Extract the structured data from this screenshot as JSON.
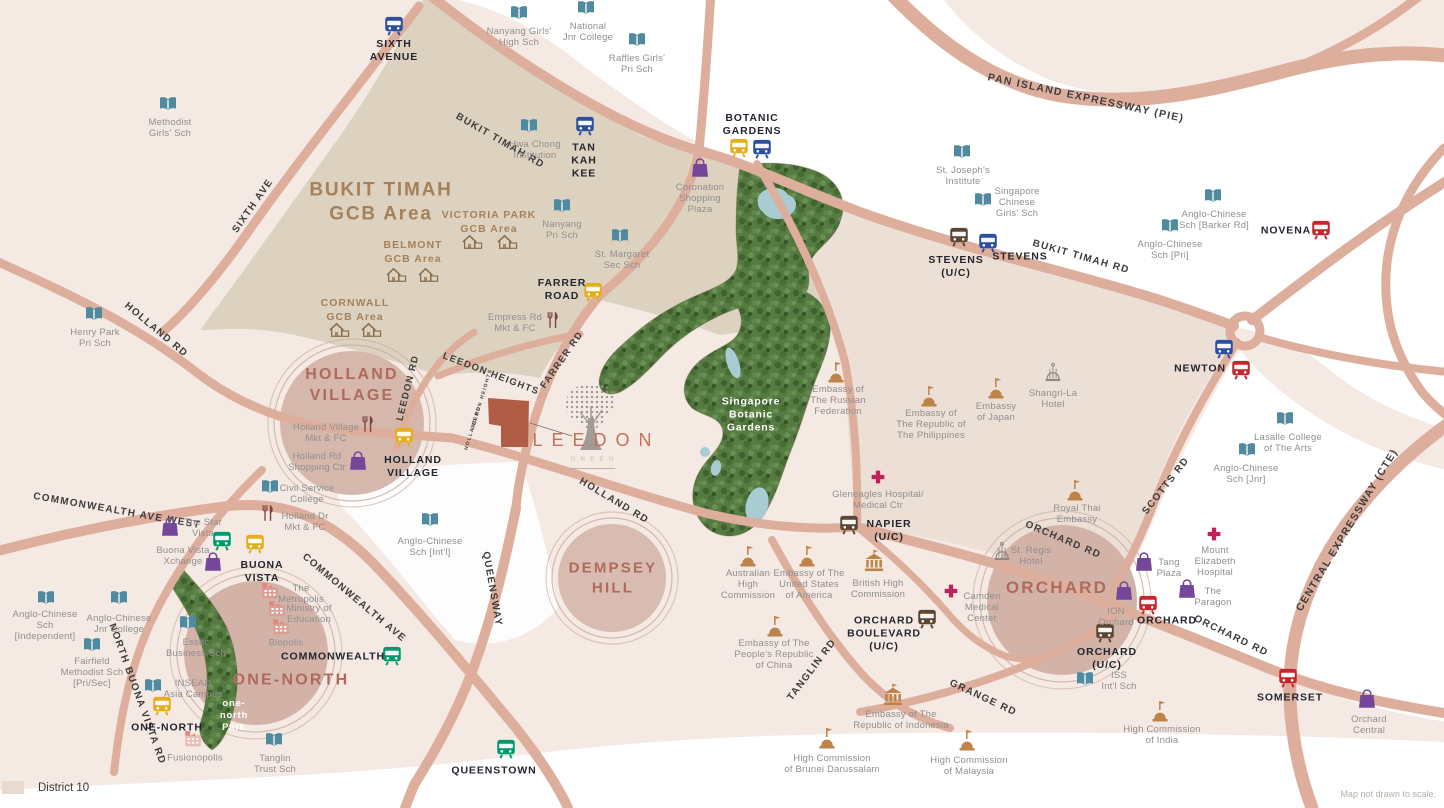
{
  "meta": {
    "district_label": "District 10",
    "footnote": "Map not drawn to scale."
  },
  "logo": {
    "name": "LEEDON",
    "sub": "GREEN"
  },
  "colors": {
    "lines": {
      "blue": "#2b4f9e",
      "yellow": "#e6ae1d",
      "green": "#009a6d",
      "red": "#c1272d",
      "brown": "#5c4733"
    },
    "poi": {
      "school": "#4f8ba0",
      "mall": "#74479a",
      "embassy": "#bd8348",
      "highcomm": "#bd8348",
      "hotel": "#8d8a84",
      "hospital": "#c21f5b",
      "market": "#7c4343",
      "biz": "#e2867e"
    },
    "road": "#deae9d",
    "site": "#b05d45",
    "accent": "#c0735a"
  },
  "areas": [
    {
      "label": "HOLLAND\nVILLAGE",
      "x": 352,
      "y": 386,
      "size": 16
    },
    {
      "label": "DEMPSEY\nHILL",
      "x": 613,
      "y": 578,
      "size": 15
    },
    {
      "label": "ORCHARD",
      "x": 1057,
      "y": 588,
      "size": 17
    },
    {
      "label": "ONE-NORTH",
      "x": 291,
      "y": 681,
      "size": 16
    }
  ],
  "parks": [
    {
      "label": "Singapore\nBotanic\nGardens",
      "x": 751,
      "y": 415,
      "size": 10.5
    },
    {
      "label": "one-\nnorth\nPark",
      "x": 234,
      "y": 716,
      "size": 9.5
    }
  ],
  "gcb": {
    "main": {
      "label": "BUKIT TIMAH\nGCB Area",
      "x": 381,
      "y": 202
    },
    "estates": [
      {
        "label": "VICTORIA PARK\nGCB Area",
        "x": 489,
        "y": 222,
        "houses": [
          [
            472,
            243
          ],
          [
            507,
            243
          ]
        ]
      },
      {
        "label": "BELMONT\nGCB Area",
        "x": 413,
        "y": 252,
        "houses": [
          [
            396,
            276
          ],
          [
            428,
            276
          ]
        ]
      },
      {
        "label": "CORNWALL\nGCB Area",
        "x": 355,
        "y": 310,
        "houses": [
          [
            339,
            331
          ],
          [
            371,
            331
          ]
        ]
      }
    ]
  },
  "road_labels": [
    {
      "label": "BUKIT TIMAH RD",
      "x": 500,
      "y": 141,
      "rot": 30,
      "size": 10
    },
    {
      "label": "BUKIT TIMAH RD",
      "x": 1081,
      "y": 257,
      "rot": 16,
      "size": 10
    },
    {
      "label": "PAN ISLAND EXPRESSWAY (PIE)",
      "x": 1086,
      "y": 98,
      "rot": 12,
      "size": 10.5
    },
    {
      "label": "SIXTH AVE",
      "x": 253,
      "y": 206,
      "rot": -55,
      "size": 10
    },
    {
      "label": "HOLLAND RD",
      "x": 156,
      "y": 330,
      "rot": 40,
      "size": 10
    },
    {
      "label": "HOLLAND RD",
      "x": 614,
      "y": 501,
      "rot": 31,
      "size": 10
    },
    {
      "label": "LEEDON RD",
      "x": 408,
      "y": 388,
      "rot": -76,
      "size": 9.5
    },
    {
      "label": "LEEDON HEIGHTS",
      "x": 491,
      "y": 374,
      "rot": 21,
      "size": 9.5
    },
    {
      "label": "FARRER RD",
      "x": 562,
      "y": 360,
      "rot": -55,
      "size": 9.5
    },
    {
      "label": "QUEENSWAY",
      "x": 492,
      "y": 589,
      "rot": 80,
      "size": 10
    },
    {
      "label": "COMMONWEALTH AVE WEST",
      "x": 117,
      "y": 511,
      "rot": 10,
      "size": 10
    },
    {
      "label": "COMMONWEALTH AVE",
      "x": 354,
      "y": 598,
      "rot": 40,
      "size": 10
    },
    {
      "label": "NORTH BUONA VISTA RD",
      "x": 137,
      "y": 694,
      "rot": 70,
      "size": 10
    },
    {
      "label": "TANGLIN RD",
      "x": 812,
      "y": 670,
      "rot": -53,
      "size": 10
    },
    {
      "label": "GRANGE RD",
      "x": 983,
      "y": 698,
      "rot": 25,
      "size": 10
    },
    {
      "label": "ORCHARD RD",
      "x": 1063,
      "y": 540,
      "rot": 23,
      "size": 10
    },
    {
      "label": "ORCHARD RD",
      "x": 1231,
      "y": 636,
      "rot": 26,
      "size": 10
    },
    {
      "label": "SCOTTS RD",
      "x": 1166,
      "y": 486,
      "rot": -52,
      "size": 10
    },
    {
      "label": "CENTRAL EXPRESSWAY (CTE)",
      "x": 1347,
      "y": 530,
      "rot": -59,
      "size": 10.5
    },
    {
      "label": "LEEDON HEIGHTS",
      "x": 482,
      "y": 399,
      "rot": -73,
      "size": 5
    },
    {
      "label": "HOLLAND RD",
      "x": 473,
      "y": 428,
      "rot": -73,
      "size": 5
    }
  ],
  "transit": [
    {
      "label": "SIXTH\nAVENUE",
      "x": 394,
      "y": 51,
      "icons": [
        {
          "line": "blue",
          "x": 394,
          "y": 26
        }
      ]
    },
    {
      "label": "TAN\nKAH\nKEE",
      "x": 584,
      "y": 161,
      "icons": [
        {
          "line": "blue",
          "x": 585,
          "y": 126
        }
      ]
    },
    {
      "label": "BOTANIC\nGARDENS",
      "x": 752,
      "y": 125,
      "icons": [
        {
          "line": "yellow",
          "x": 739,
          "y": 148
        },
        {
          "line": "blue",
          "x": 762,
          "y": 149
        }
      ]
    },
    {
      "label": "STEVENS\n(U/C)",
      "x": 956,
      "y": 267,
      "icons": [
        {
          "line": "brown",
          "x": 959,
          "y": 237
        }
      ]
    },
    {
      "label": "STEVENS",
      "x": 1020,
      "y": 257,
      "icons": [
        {
          "line": "blue",
          "x": 988,
          "y": 243
        }
      ]
    },
    {
      "label": "NOVENA",
      "x": 1286,
      "y": 231,
      "icons": [
        {
          "line": "red",
          "x": 1321,
          "y": 230
        }
      ]
    },
    {
      "label": "NEWTON",
      "x": 1200,
      "y": 369,
      "icons": [
        {
          "line": "blue",
          "x": 1224,
          "y": 349
        },
        {
          "line": "red",
          "x": 1241,
          "y": 370
        }
      ]
    },
    {
      "label": "FARRER\nROAD",
      "x": 562,
      "y": 290,
      "icons": [
        {
          "line": "yellow",
          "x": 593,
          "y": 292
        }
      ]
    },
    {
      "label": "HOLLAND\nVILLAGE",
      "x": 413,
      "y": 467,
      "icons": [
        {
          "line": "yellow",
          "x": 404,
          "y": 437
        }
      ]
    },
    {
      "label": "BUONA\nVISTA",
      "x": 262,
      "y": 572,
      "icons": [
        {
          "line": "green",
          "x": 222,
          "y": 541
        },
        {
          "line": "yellow",
          "x": 255,
          "y": 544
        }
      ]
    },
    {
      "label": "COMMONWEALTH",
      "x": 333,
      "y": 657,
      "icons": [
        {
          "line": "green",
          "x": 392,
          "y": 656
        }
      ]
    },
    {
      "label": "ONE-NORTH",
      "x": 167,
      "y": 728,
      "icons": [
        {
          "line": "yellow",
          "x": 162,
          "y": 706
        }
      ]
    },
    {
      "label": "QUEENSTOWN",
      "x": 494,
      "y": 771,
      "icons": [
        {
          "line": "green",
          "x": 506,
          "y": 749
        }
      ]
    },
    {
      "label": "NAPIER\n(U/C)",
      "x": 889,
      "y": 531,
      "icons": [
        {
          "line": "brown",
          "x": 849,
          "y": 525
        }
      ]
    },
    {
      "label": "ORCHARD\nBOULEVARD\n(U/C)",
      "x": 884,
      "y": 634,
      "icons": [
        {
          "line": "brown",
          "x": 927,
          "y": 619
        }
      ]
    },
    {
      "label": "ORCHARD",
      "x": 1167,
      "y": 621,
      "icons": [
        {
          "line": "red",
          "x": 1148,
          "y": 605
        }
      ]
    },
    {
      "label": "ORCHARD\n(U/C)",
      "x": 1107,
      "y": 659,
      "icons": [
        {
          "line": "brown",
          "x": 1105,
          "y": 633
        }
      ]
    },
    {
      "label": "SOMERSET",
      "x": 1290,
      "y": 698,
      "icons": [
        {
          "line": "red",
          "x": 1288,
          "y": 678
        }
      ]
    }
  ],
  "pois": [
    {
      "type": "school",
      "label": "Methodist\nGirls' Sch",
      "ix": 168,
      "iy": 104,
      "lx": 170,
      "ly": 128
    },
    {
      "type": "school",
      "label": "Nanyang Girls'\nHigh Sch",
      "ix": 519,
      "iy": 13,
      "lx": 519,
      "ly": 37
    },
    {
      "type": "school",
      "label": "National\nJnr College",
      "ix": 586,
      "iy": 8,
      "lx": 588,
      "ly": 32
    },
    {
      "type": "school",
      "label": "Raffles Girls'\nPri Sch",
      "ix": 637,
      "iy": 40,
      "lx": 637,
      "ly": 64
    },
    {
      "type": "school",
      "label": "Hwa Chong\nInstitution",
      "ix": 529,
      "iy": 126,
      "lx": 535,
      "ly": 150
    },
    {
      "type": "school",
      "label": "Nanyang\nPri Sch",
      "ix": 562,
      "iy": 206,
      "lx": 562,
      "ly": 230
    },
    {
      "type": "school",
      "label": "St. Margaret\nSec Sch",
      "ix": 620,
      "iy": 236,
      "lx": 622,
      "ly": 260
    },
    {
      "type": "school",
      "label": "St. Joseph's\nInstitute",
      "ix": 962,
      "iy": 152,
      "lx": 963,
      "ly": 176
    },
    {
      "type": "school",
      "label": "Singapore\nChinese\nGirls' Sch",
      "ix": 983,
      "iy": 200,
      "lx": 1017,
      "ly": 203
    },
    {
      "type": "school",
      "label": "Anglo-Chinese\nSch [Barker Rd]",
      "ix": 1213,
      "iy": 196,
      "lx": 1214,
      "ly": 220
    },
    {
      "type": "school",
      "label": "Anglo-Chinese\nSch [Pri]",
      "ix": 1170,
      "iy": 226,
      "lx": 1170,
      "ly": 250
    },
    {
      "type": "school",
      "label": "Henry Park\nPri Sch",
      "ix": 94,
      "iy": 314,
      "lx": 95,
      "ly": 338
    },
    {
      "type": "school",
      "label": "Civil Service\nCollege",
      "ix": 270,
      "iy": 487,
      "lx": 307,
      "ly": 494
    },
    {
      "type": "school",
      "label": "Anglo-Chinese\nSch [Int'l]",
      "ix": 430,
      "iy": 520,
      "lx": 430,
      "ly": 547
    },
    {
      "type": "school",
      "label": "Anglo-Chinese\nSch\n[Independent]",
      "ix": 46,
      "iy": 598,
      "lx": 45,
      "ly": 626
    },
    {
      "type": "school",
      "label": "Anglo-Chinese\nJnr College",
      "ix": 119,
      "iy": 598,
      "lx": 119,
      "ly": 624
    },
    {
      "type": "school",
      "label": "Fairfield\nMethodist Sch\n[Pri/Sec]",
      "ix": 92,
      "iy": 645,
      "lx": 92,
      "ly": 673
    },
    {
      "type": "school",
      "label": "Essec\nBusiness Sch",
      "ix": 188,
      "iy": 623,
      "lx": 196,
      "ly": 648
    },
    {
      "type": "school",
      "label": "INSEAD\nAsia Campus",
      "ix": 153,
      "iy": 686,
      "lx": 193,
      "ly": 689
    },
    {
      "type": "school",
      "label": "Tanglin\nTrust Sch",
      "ix": 274,
      "iy": 740,
      "lx": 275,
      "ly": 764
    },
    {
      "type": "school",
      "label": "Lasalle College\nof The Arts",
      "ix": 1285,
      "iy": 419,
      "lx": 1288,
      "ly": 443
    },
    {
      "type": "school",
      "label": "Anglo-Chinese\nSch [Jnr]",
      "ix": 1247,
      "iy": 450,
      "lx": 1246,
      "ly": 474
    },
    {
      "type": "school",
      "label": "ISS\nInt'l Sch",
      "ix": 1085,
      "iy": 679,
      "lx": 1119,
      "ly": 681
    },
    {
      "type": "mall",
      "label": "Coronation\nShopping\nPlaza",
      "ix": 700,
      "iy": 168,
      "lx": 700,
      "ly": 199
    },
    {
      "type": "mall",
      "label": "Holland Rd\nShopping Ctr",
      "ix": 358,
      "iy": 461,
      "lx": 317,
      "ly": 462
    },
    {
      "type": "mall",
      "label": "The Star\nVista",
      "ix": 170,
      "iy": 527,
      "lx": 203,
      "ly": 528
    },
    {
      "type": "mall",
      "label": "Buona Vista\nXchange",
      "ix": 213,
      "iy": 562,
      "lx": 183,
      "ly": 556
    },
    {
      "type": "mall",
      "label": "Tang\nPlaza",
      "ix": 1144,
      "iy": 562,
      "lx": 1169,
      "ly": 568
    },
    {
      "type": "mall",
      "label": "The\nParagon",
      "ix": 1187,
      "iy": 589,
      "lx": 1213,
      "ly": 597
    },
    {
      "type": "mall",
      "label": "ION\nOrchard",
      "ix": 1124,
      "iy": 591,
      "lx": 1116,
      "ly": 617
    },
    {
      "type": "mall",
      "label": "Orchard\nCentral",
      "ix": 1367,
      "iy": 699,
      "lx": 1369,
      "ly": 725
    },
    {
      "type": "embassy",
      "label": "Embassy of\nThe Russian\nFederation",
      "ix": 836,
      "iy": 372,
      "lx": 838,
      "ly": 401
    },
    {
      "type": "embassy",
      "label": "Embassy of\nThe Republic of\nThe Philippines",
      "ix": 929,
      "iy": 396,
      "lx": 931,
      "ly": 425
    },
    {
      "type": "embassy",
      "label": "Embassy\nof Japan",
      "ix": 996,
      "iy": 388,
      "lx": 996,
      "ly": 412
    },
    {
      "type": "embassy",
      "label": "Royal Thai\nEmbassy",
      "ix": 1075,
      "iy": 490,
      "lx": 1077,
      "ly": 514
    },
    {
      "type": "embassy",
      "label": "Embassy of The\nPeople's Republic\nof China",
      "ix": 775,
      "iy": 626,
      "lx": 774,
      "ly": 655
    },
    {
      "type": "embassy",
      "label": "High Commission\nof Brunei Darussalam",
      "ix": 827,
      "iy": 738,
      "lx": 832,
      "ly": 764
    },
    {
      "type": "embassy",
      "label": "High Commission\nof Malaysia",
      "ix": 967,
      "iy": 740,
      "lx": 969,
      "ly": 766
    },
    {
      "type": "embassy",
      "label": "High Commission\nof India",
      "ix": 1160,
      "iy": 711,
      "lx": 1162,
      "ly": 735
    },
    {
      "type": "embassy",
      "label": "Australian\nHigh\nCommission",
      "ix": 748,
      "iy": 556,
      "lx": 748,
      "ly": 585
    },
    {
      "type": "embassy",
      "label": "Embassy of The\nUnited States\nof America",
      "ix": 807,
      "iy": 556,
      "lx": 809,
      "ly": 585
    },
    {
      "type": "highcomm",
      "label": "British High\nCommission",
      "ix": 874,
      "iy": 561,
      "lx": 878,
      "ly": 589
    },
    {
      "type": "highcomm",
      "label": "Embassy of The\nRepublic of Indonesia",
      "ix": 893,
      "iy": 695,
      "lx": 901,
      "ly": 720
    },
    {
      "type": "hotel",
      "label": "Shangri-La\nHotel",
      "ix": 1053,
      "iy": 373,
      "lx": 1053,
      "ly": 399
    },
    {
      "type": "hotel",
      "label": "St. Regis\nHotel",
      "ix": 1002,
      "iy": 552,
      "lx": 1031,
      "ly": 556
    },
    {
      "type": "hospital",
      "label": "Gleneagles Hospital/\nMedical Ctr",
      "ix": 878,
      "iy": 477,
      "lx": 878,
      "ly": 500
    },
    {
      "type": "hospital",
      "label": "Mount\nElizabeth\nHospital",
      "ix": 1214,
      "iy": 534,
      "lx": 1215,
      "ly": 562
    },
    {
      "type": "hospital",
      "label": "Camden\nMedical\nCenter",
      "ix": 951,
      "iy": 591,
      "lx": 982,
      "ly": 608
    },
    {
      "type": "market",
      "label": "Empress Rd\nMkt & FC",
      "ix": 553,
      "iy": 320,
      "lx": 515,
      "ly": 323
    },
    {
      "type": "market",
      "label": "Holland Village\nMkt & FC",
      "ix": 368,
      "iy": 424,
      "lx": 326,
      "ly": 433
    },
    {
      "type": "market",
      "label": "Holland Dr\nMkt & FC",
      "ix": 268,
      "iy": 513,
      "lx": 305,
      "ly": 522
    },
    {
      "type": "biz",
      "label": "The\nMetropolis",
      "ix": 270,
      "iy": 590,
      "lx": 301,
      "ly": 594
    },
    {
      "type": "biz",
      "label": "Ministry of\nEducation",
      "ix": 277,
      "iy": 608,
      "lx": 309,
      "ly": 614
    },
    {
      "type": "biz",
      "label": "Biopolis",
      "ix": 281,
      "iy": 626,
      "lx": 286,
      "ly": 643
    },
    {
      "type": "biz",
      "label": "Fusionopolis",
      "ix": 193,
      "iy": 738,
      "lx": 195,
      "ly": 758
    }
  ]
}
